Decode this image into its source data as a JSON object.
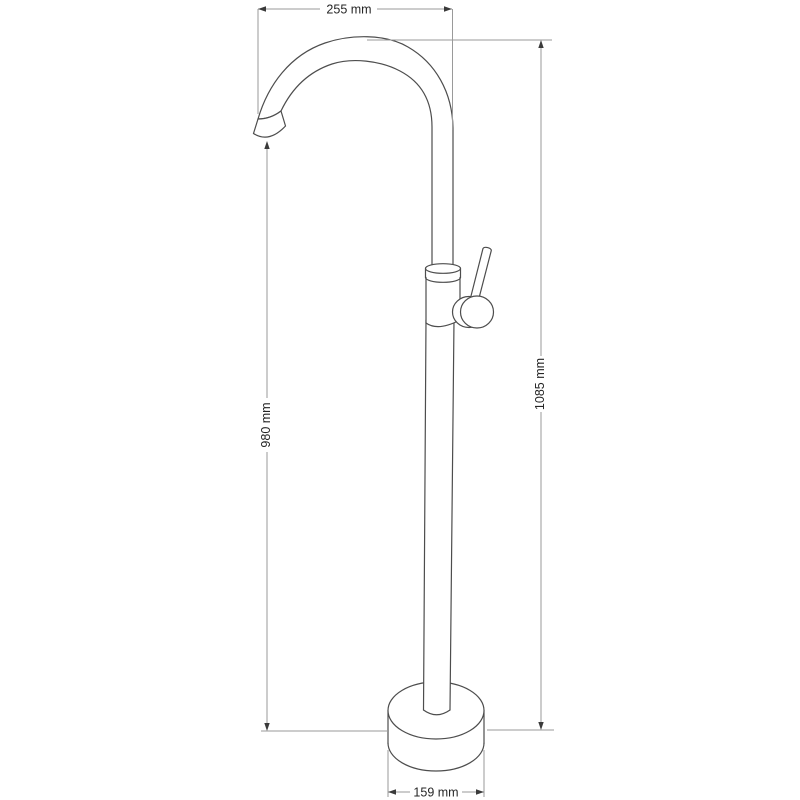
{
  "diagram": {
    "subject": "Freestanding bathtub faucet technical dimension drawing",
    "background_color": "#ffffff",
    "outline_color": "#4d4d4d",
    "dimension_line_color": "#9a9a9a",
    "arrow_color": "#3a3a3a",
    "text_color": "#262626",
    "dimensions": {
      "top_width": {
        "label": "255 mm",
        "orientation": "horizontal",
        "measures": "spout reach from tip to riser"
      },
      "spout_height": {
        "label": "980 mm",
        "orientation": "vertical",
        "measures": "spout outlet height above base"
      },
      "total_height": {
        "label": "1085 mm",
        "orientation": "vertical",
        "measures": "overall height above base"
      },
      "base_diameter": {
        "label": "159 mm",
        "orientation": "horizontal",
        "measures": "base diameter"
      }
    }
  }
}
